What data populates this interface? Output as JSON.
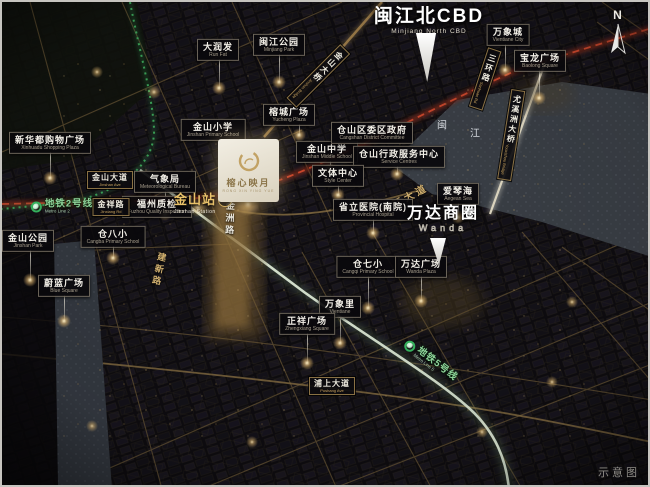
{
  "meta": {
    "caption": "示意图",
    "compass": "N"
  },
  "colors": {
    "gold": "#d8b878",
    "metro_green": "#35b05c",
    "artery_red": "#d14a2e",
    "river": "#3b4047",
    "plaque_border": "#b6ab90",
    "project_cream": "#efe9da"
  },
  "project": {
    "name_zh": "榕心映月",
    "name_en": "RONG XIN YING YUE"
  },
  "station": {
    "zh": "金山站",
    "badge": "2",
    "en": "Jinshan Station"
  },
  "river": {
    "name": "闽江",
    "chars": [
      {
        "ch": "闽",
        "x": 440,
        "y": 122
      },
      {
        "ch": "江",
        "x": 473,
        "y": 130
      }
    ]
  },
  "big_labels": [
    {
      "id": "minjiang-north-cbd",
      "zh": "闽江北CBD",
      "en": "Minjiang North CBD",
      "x": 427,
      "y": 16,
      "arrow": {
        "x": 424,
        "y": 31,
        "w": 24,
        "h": 49
      }
    },
    {
      "id": "wanda-circle",
      "zh": "万达商圈",
      "en": "Wanda",
      "outline": true,
      "small": true,
      "x": 441,
      "y": 214,
      "arrow": {
        "x": 436,
        "y": 236,
        "w": 19,
        "h": 27
      }
    }
  ],
  "pois": [
    {
      "id": "darunfa",
      "zh": "大润发",
      "en": "Run Fat",
      "x": 216,
      "y": 48,
      "dot": [
        217,
        86
      ]
    },
    {
      "id": "minjiang-park",
      "zh": "闽江公园",
      "en": "Minjiang Park",
      "x": 277,
      "y": 43,
      "dot": [
        277,
        80
      ]
    },
    {
      "id": "wanxiang-city",
      "zh": "万象城",
      "en": "Vientiane City",
      "x": 506,
      "y": 33,
      "dot": [
        503,
        68
      ]
    },
    {
      "id": "baolong-square",
      "zh": "宝龙广场",
      "en": "Baolong Square",
      "x": 538,
      "y": 59,
      "dot": [
        537,
        96
      ]
    },
    {
      "id": "xinhuadu-plaza",
      "zh": "新华都购物广场",
      "en": "Xinhuadu Shopping Plaza",
      "x": 48,
      "y": 141,
      "dot": [
        48,
        176
      ]
    },
    {
      "id": "jinshan-primary",
      "zh": "金山小学",
      "en": "Jinshan Primary School",
      "x": 211,
      "y": 128
    },
    {
      "id": "rongcheng-plaza",
      "zh": "榕城广场",
      "en": "Yucheng Plaza",
      "x": 287,
      "y": 113,
      "dot": [
        297,
        133
      ]
    },
    {
      "id": "weather-bureau",
      "zh": "气象局",
      "en": "Meteorological Bureau",
      "x": 163,
      "y": 180,
      "dot": [
        163,
        212
      ]
    },
    {
      "id": "jinshan-middle",
      "zh": "金山中学",
      "en": "Jinshan Middle School",
      "x": 325,
      "y": 150,
      "dot": [
        328,
        168
      ]
    },
    {
      "id": "cangshan-committee",
      "zh": "仓山区委区政府",
      "en": "Cangshan District Committee",
      "x": 370,
      "y": 131
    },
    {
      "id": "admin-service-center",
      "zh": "仓山行政服务中心",
      "en": "Service Centres",
      "x": 397,
      "y": 155,
      "dot": [
        395,
        172
      ]
    },
    {
      "id": "style-center",
      "zh": "文体中心",
      "en": "Style Center",
      "x": 336,
      "y": 174,
      "dot": [
        336,
        193
      ]
    },
    {
      "id": "fuzhou-quality",
      "zh": "福州质检",
      "en": "Fuzhou Quality Inspection",
      "x": 155,
      "y": 205
    },
    {
      "id": "cangba-primary",
      "zh": "仓八小",
      "en": "Cangba Primary School",
      "x": 111,
      "y": 235,
      "dot": [
        111,
        256
      ]
    },
    {
      "id": "jinshan-park",
      "zh": "金山公园",
      "en": "Jinshan Park",
      "x": 26,
      "y": 239,
      "dot": [
        28,
        278
      ]
    },
    {
      "id": "blue-square",
      "zh": "蔚蓝广场",
      "en": "Blue Square",
      "x": 62,
      "y": 284,
      "dot": [
        62,
        319
      ]
    },
    {
      "id": "provincial-hospital",
      "zh": "省立医院(南院)",
      "en": "Provincial Hospital",
      "x": 371,
      "y": 208,
      "dot": [
        371,
        231
      ]
    },
    {
      "id": "aegean-sea",
      "zh": "爱琴海",
      "en": "Aegean Sea",
      "x": 456,
      "y": 192,
      "dot": [
        456,
        215
      ]
    },
    {
      "id": "cangqi-primary",
      "zh": "仓七小",
      "en": "Cangqi Primary School",
      "x": 366,
      "y": 265,
      "dot": [
        366,
        306
      ]
    },
    {
      "id": "wanda-plaza",
      "zh": "万达广场",
      "en": "Wanda Plaza",
      "x": 419,
      "y": 265,
      "dot": [
        419,
        299
      ]
    },
    {
      "id": "wanxiangli",
      "zh": "万象里",
      "en": "Vientiane",
      "x": 338,
      "y": 305,
      "dot": [
        338,
        341
      ]
    },
    {
      "id": "zhengxiang-square",
      "zh": "正祥广场",
      "en": "Zhengxiang Square",
      "x": 305,
      "y": 322,
      "dot": [
        305,
        361
      ]
    }
  ],
  "roads": [
    {
      "id": "jinshan-ave",
      "kind": "plaque",
      "zh": "金山大道",
      "en": "Jinshan Ave",
      "x": 108,
      "y": 178,
      "rot": 0
    },
    {
      "id": "jinxiang-rd",
      "kind": "plaque",
      "zh": "金祥路",
      "en": "Jinxiang Rd",
      "x": 109,
      "y": 205,
      "rot": 0
    },
    {
      "id": "pushang-ave",
      "kind": "plaque",
      "zh": "浦上大道",
      "en": "Pushang Ave",
      "x": 330,
      "y": 384,
      "rot": 0
    },
    {
      "id": "jinshan-bridge",
      "kind": "vplaque",
      "zh": "金山大桥",
      "en": "Jinshan Bridge",
      "x": 316,
      "y": 74,
      "rot": 45
    },
    {
      "id": "sanhuan-rd",
      "kind": "vplaque",
      "zh": "三环路",
      "en": "Sanhuan Rd",
      "x": 483,
      "y": 77,
      "rot": 18
    },
    {
      "id": "youxizhou-bridge",
      "kind": "vplaque",
      "zh": "尤溪洲大桥",
      "en": "Youxizhou Bridge",
      "x": 509,
      "y": 133,
      "rot": 9
    },
    {
      "id": "jianxin-rd",
      "kind": "vtext",
      "zh": "建新路",
      "en": "Jianxin Rd",
      "x": 157,
      "y": 268,
      "rot": 12,
      "color": "#cfae6e"
    },
    {
      "id": "jinzhou-rd",
      "kind": "vtext",
      "zh": "金洲路",
      "en": "Jinzhou Rd",
      "x": 228,
      "y": 217,
      "rot": 2,
      "color": "#e9e6dc"
    },
    {
      "id": "minjiang-ave",
      "kind": "text",
      "zh": "闽江大道",
      "en": "",
      "x": 402,
      "y": 196,
      "rot": -28
    }
  ],
  "metros": [
    {
      "id": "metro-line-2",
      "zh": "地铁2号线",
      "en": "Metro Line 2",
      "x": 60,
      "y": 205,
      "rot": 0
    },
    {
      "id": "metro-line-5",
      "zh": "地铁5号线",
      "en": "Metro Line 5",
      "x": 428,
      "y": 360,
      "rot": 38
    }
  ]
}
